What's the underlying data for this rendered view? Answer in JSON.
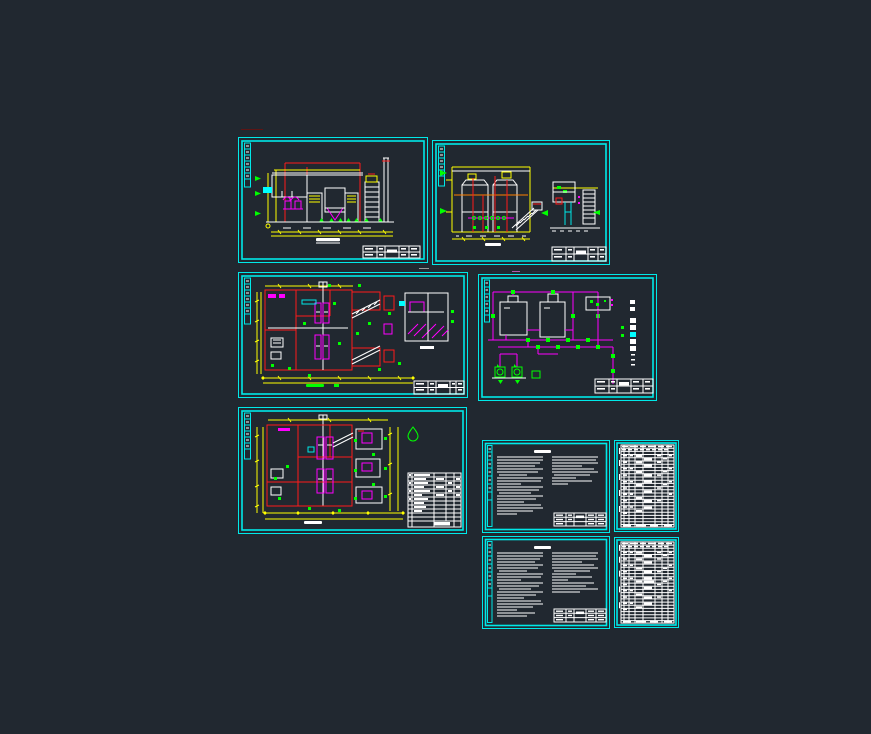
{
  "app": {
    "name": "CAD drawing viewer",
    "canvas_background": "#212830",
    "sheet_count": 9
  },
  "palette": {
    "sheet_frame": "#00e8e8",
    "linework_white": "#ffffff",
    "linework_red": "#ff1a1a",
    "linework_yellow": "#ffff00",
    "linework_green": "#00ff00",
    "linework_magenta": "#ff00ff",
    "linework_orange": "#ff8000"
  },
  "sheets": [
    {
      "id": "sheet-1",
      "label": "treatment equipment elevation section drawing A"
    },
    {
      "id": "sheet-2",
      "label": "treatment tanks elevation section drawing B with side detail"
    },
    {
      "id": "sheet-3",
      "label": "treatment station floor plan with detail view"
    },
    {
      "id": "sheet-4",
      "label": "process flow piping diagram"
    },
    {
      "id": "sheet-5",
      "label": "equipment layout floor plan with material table"
    },
    {
      "id": "sheet-6",
      "label": "design notes sheet 1"
    },
    {
      "id": "sheet-7",
      "label": "equipment and material schedule table 1"
    },
    {
      "id": "sheet-8",
      "label": "design notes sheet 2"
    },
    {
      "id": "sheet-9",
      "label": "equipment and material schedule table 2"
    }
  ]
}
